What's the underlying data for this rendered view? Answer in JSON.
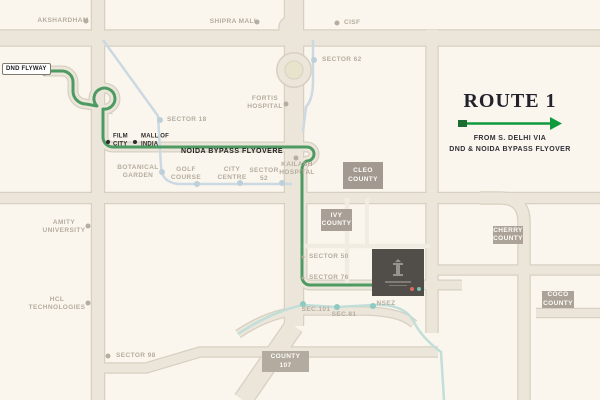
{
  "route_panel": {
    "title": "ROUTE 1",
    "caption_line1": "FROM S. DELHI VIA",
    "caption_line2": "DND & NOIDA BYPASS FLYOVER"
  },
  "route_labels": {
    "start_badge": "DND FLYWAY",
    "flyover": "NOIDA BYPASS FLYOVERE"
  },
  "colors": {
    "background": "#faf6ed",
    "route_green": "#4e9a63",
    "arrow_green": "#0f9a3e",
    "arrow_square": "#1d6d33",
    "road_fill": "#ebe6d9",
    "road_casing": "#d7d0c2",
    "metro_blue": "#ccd8e2",
    "metro_aqua": "#c2ded9",
    "label_muted": "#b6ac9f",
    "county_bg": "#a69e93",
    "project_bg": "#514d49"
  },
  "dot_styles": {
    "muted": {
      "hex": "#b6ac9f",
      "size": 5
    },
    "dark": {
      "hex": "#2b2b2b",
      "size": 4
    },
    "blue": {
      "hex": "#bdd0da",
      "size": 6
    },
    "teal": {
      "hex": "#8fc9c1",
      "size": 6
    },
    "tiny": {
      "hex": "#b3a99c",
      "size": 3
    },
    "poi-red": {
      "hex": "#d96a5f",
      "size": 4
    },
    "poi-teal": {
      "hex": "#6fbfb4",
      "size": 4
    }
  },
  "map": {
    "labels": [
      {
        "id": "akshardham",
        "text": "AKSHARDHAM",
        "x": 63,
        "y": 21,
        "align": "center",
        "tone": "muted",
        "dot": {
          "x": 86,
          "y": 21,
          "kind": "muted"
        }
      },
      {
        "id": "shipra-mall",
        "text": "SHIPRA MALL",
        "x": 234,
        "y": 22,
        "align": "center",
        "tone": "muted",
        "dot": {
          "x": 257,
          "y": 22,
          "kind": "muted"
        }
      },
      {
        "id": "cisf",
        "text": "CISF",
        "x": 344,
        "y": 23,
        "align": "left",
        "tone": "muted",
        "dot": {
          "x": 337,
          "y": 23,
          "kind": "muted"
        }
      },
      {
        "id": "sector-62",
        "text": "SECTOR 62",
        "x": 322,
        "y": 60,
        "align": "left",
        "tone": "muted",
        "dot": {
          "x": 314,
          "y": 60,
          "kind": "blue"
        }
      },
      {
        "id": "fortis-hospital",
        "text": "FORTIS\nHOSPITAL",
        "x": 265,
        "y": 103,
        "align": "center",
        "tone": "muted",
        "dot": {
          "x": 286,
          "y": 104,
          "kind": "muted"
        }
      },
      {
        "id": "sector-18",
        "text": "SECTOR 18",
        "x": 167,
        "y": 120,
        "align": "left",
        "tone": "muted",
        "dot": {
          "x": 160,
          "y": 120,
          "kind": "blue"
        }
      },
      {
        "id": "film-city",
        "text": "FILM\nCITY",
        "x": 113,
        "y": 141,
        "align": "left",
        "tone": "dark",
        "dot": {
          "x": 108,
          "y": 142,
          "kind": "dark"
        }
      },
      {
        "id": "mall-of-india",
        "text": "MALL OF\nINDIA",
        "x": 141,
        "y": 141,
        "align": "left",
        "tone": "dark",
        "dot": {
          "x": 135,
          "y": 142,
          "kind": "dark"
        }
      },
      {
        "id": "botanical-garden",
        "text": "BOTANICAL\nGARDEN",
        "x": 138,
        "y": 172,
        "align": "center",
        "tone": "muted",
        "dot": {
          "x": 162,
          "y": 172,
          "kind": "blue"
        }
      },
      {
        "id": "golf-course",
        "text": "GOLF\nCOURSE",
        "x": 186,
        "y": 174,
        "align": "center",
        "tone": "muted",
        "dot": {
          "x": 197,
          "y": 184,
          "kind": "blue"
        }
      },
      {
        "id": "city-centre",
        "text": "CITY\nCENTRE",
        "x": 232,
        "y": 174,
        "align": "center",
        "tone": "muted",
        "dot": {
          "x": 240,
          "y": 183,
          "kind": "blue"
        }
      },
      {
        "id": "sector-52",
        "text": "SECTOR\n52",
        "x": 264,
        "y": 175,
        "align": "center",
        "tone": "muted",
        "dot": {
          "x": 282,
          "y": 183,
          "kind": "blue"
        }
      },
      {
        "id": "kailash-hospital",
        "text": "KAILASH\nHOSPITAL",
        "x": 297,
        "y": 169,
        "align": "center",
        "tone": "muted",
        "dot": {
          "x": 296,
          "y": 158,
          "kind": "muted"
        }
      },
      {
        "id": "amity-university",
        "text": "AMITY\nUNIVERSITY",
        "x": 64,
        "y": 227,
        "align": "center",
        "tone": "muted",
        "dot": {
          "x": 88,
          "y": 226,
          "kind": "muted"
        }
      },
      {
        "id": "hcl-technologies",
        "text": "HCL\nTECHNOLOGIES",
        "x": 57,
        "y": 304,
        "align": "center",
        "tone": "muted",
        "dot": {
          "x": 88,
          "y": 303,
          "kind": "muted"
        }
      },
      {
        "id": "sector-98",
        "text": "SECTOR 98",
        "x": 116,
        "y": 356,
        "align": "left",
        "tone": "muted",
        "dot": {
          "x": 108,
          "y": 356,
          "kind": "muted"
        }
      },
      {
        "id": "sector-50",
        "text": "SECTOR 50",
        "x": 309,
        "y": 257,
        "align": "left",
        "tone": "muted",
        "dot": {
          "x": 303,
          "y": 257,
          "kind": "tiny"
        }
      },
      {
        "id": "sector-76",
        "text": "SECTOR 76",
        "x": 309,
        "y": 278,
        "align": "left",
        "tone": "muted",
        "dot": {
          "x": 303,
          "y": 278,
          "kind": "tiny"
        }
      },
      {
        "id": "sec-101",
        "text": "SEC.101",
        "x": 316,
        "y": 310,
        "align": "center",
        "tone": "muted",
        "dot": {
          "x": 303,
          "y": 304,
          "kind": "teal"
        }
      },
      {
        "id": "sec-81",
        "text": "SEC.81",
        "x": 344,
        "y": 315,
        "align": "center",
        "tone": "muted",
        "dot": {
          "x": 337,
          "y": 307,
          "kind": "teal"
        }
      },
      {
        "id": "nsez",
        "text": "NSEZ",
        "x": 386,
        "y": 304,
        "align": "center",
        "tone": "muted",
        "dot": {
          "x": 373,
          "y": 306,
          "kind": "teal"
        }
      }
    ],
    "poi_markers": [
      {
        "id": "poi-red",
        "x": 412,
        "y": 289,
        "kind": "poi-red"
      },
      {
        "id": "poi-teal",
        "x": 419,
        "y": 289,
        "kind": "poi-teal"
      }
    ],
    "counties": [
      {
        "id": "cleo-county",
        "text": "CLEO\nCOUNTY",
        "x": 343,
        "y": 162,
        "w": 40,
        "h": 27,
        "bg": "#a29a90"
      },
      {
        "id": "ivy-county",
        "text": "IVY\nCOUNTY",
        "x": 321,
        "y": 209,
        "w": 31,
        "h": 22,
        "bg": "#a8a096"
      },
      {
        "id": "cherry-county",
        "text": "CHERRY\nCOUNTY",
        "x": 493,
        "y": 226,
        "w": 30,
        "h": 18,
        "bg": "#aba398"
      },
      {
        "id": "coco-county",
        "text": "COCO\nCOUNTY",
        "x": 542,
        "y": 291,
        "w": 32,
        "h": 17,
        "bg": "#aba398"
      },
      {
        "id": "county-107",
        "text": "COUNTY\n107",
        "x": 262,
        "y": 351,
        "w": 47,
        "h": 21,
        "bg": "#b3aba0"
      }
    ]
  }
}
